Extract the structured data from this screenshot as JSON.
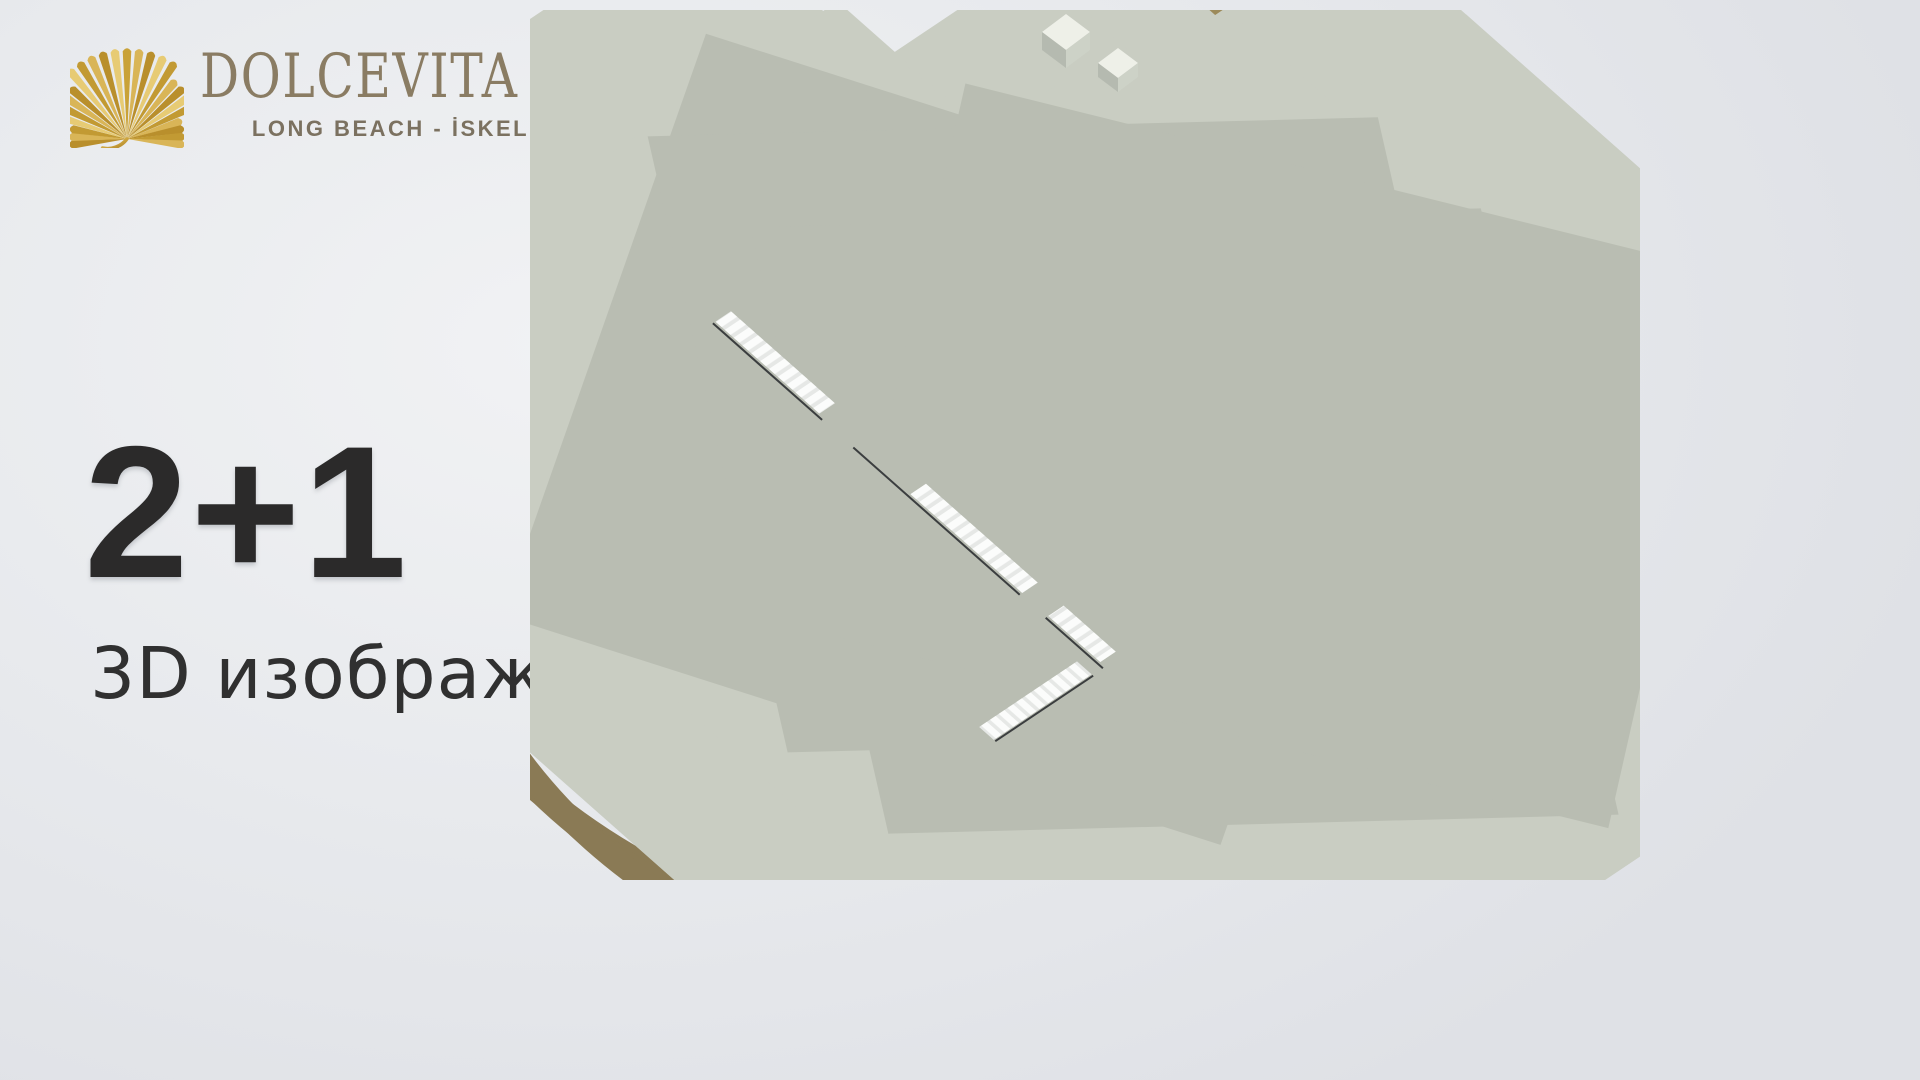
{
  "brand": {
    "name": "DOLCEVITA",
    "tagline": "LONG BEACH - İSKELE",
    "logo_icon": "palm-leaf-icon"
  },
  "hero": {
    "headline": "2+1",
    "subheadline": "3D изображение"
  },
  "theme": {
    "background_light": "#f1f2f4",
    "background_dark": "#dfe1e6",
    "headline_color": "#2b2a2a",
    "subheadline_color": "#303030",
    "brand_gold": "#cda43e",
    "brand_gold_light": "#e8cc74",
    "brand_text": "#8a7c63",
    "brand_tagline": "#7b7160",
    "wall_top": "#edefe7",
    "wall_side_dark": "#62675c",
    "wall_side_light": "#848a7e",
    "marble_floor": "#f2f2f4",
    "wood_floor_gray": "#b1b0af",
    "grass_green": "#64984a",
    "bath_floor_taupe": "#b7ac9e",
    "dark_furniture": "#1a1c1e",
    "sofa_gray": "#a69f99",
    "accent_orange": "#b06a36",
    "accent_yellow": "#d6de4e"
  }
}
